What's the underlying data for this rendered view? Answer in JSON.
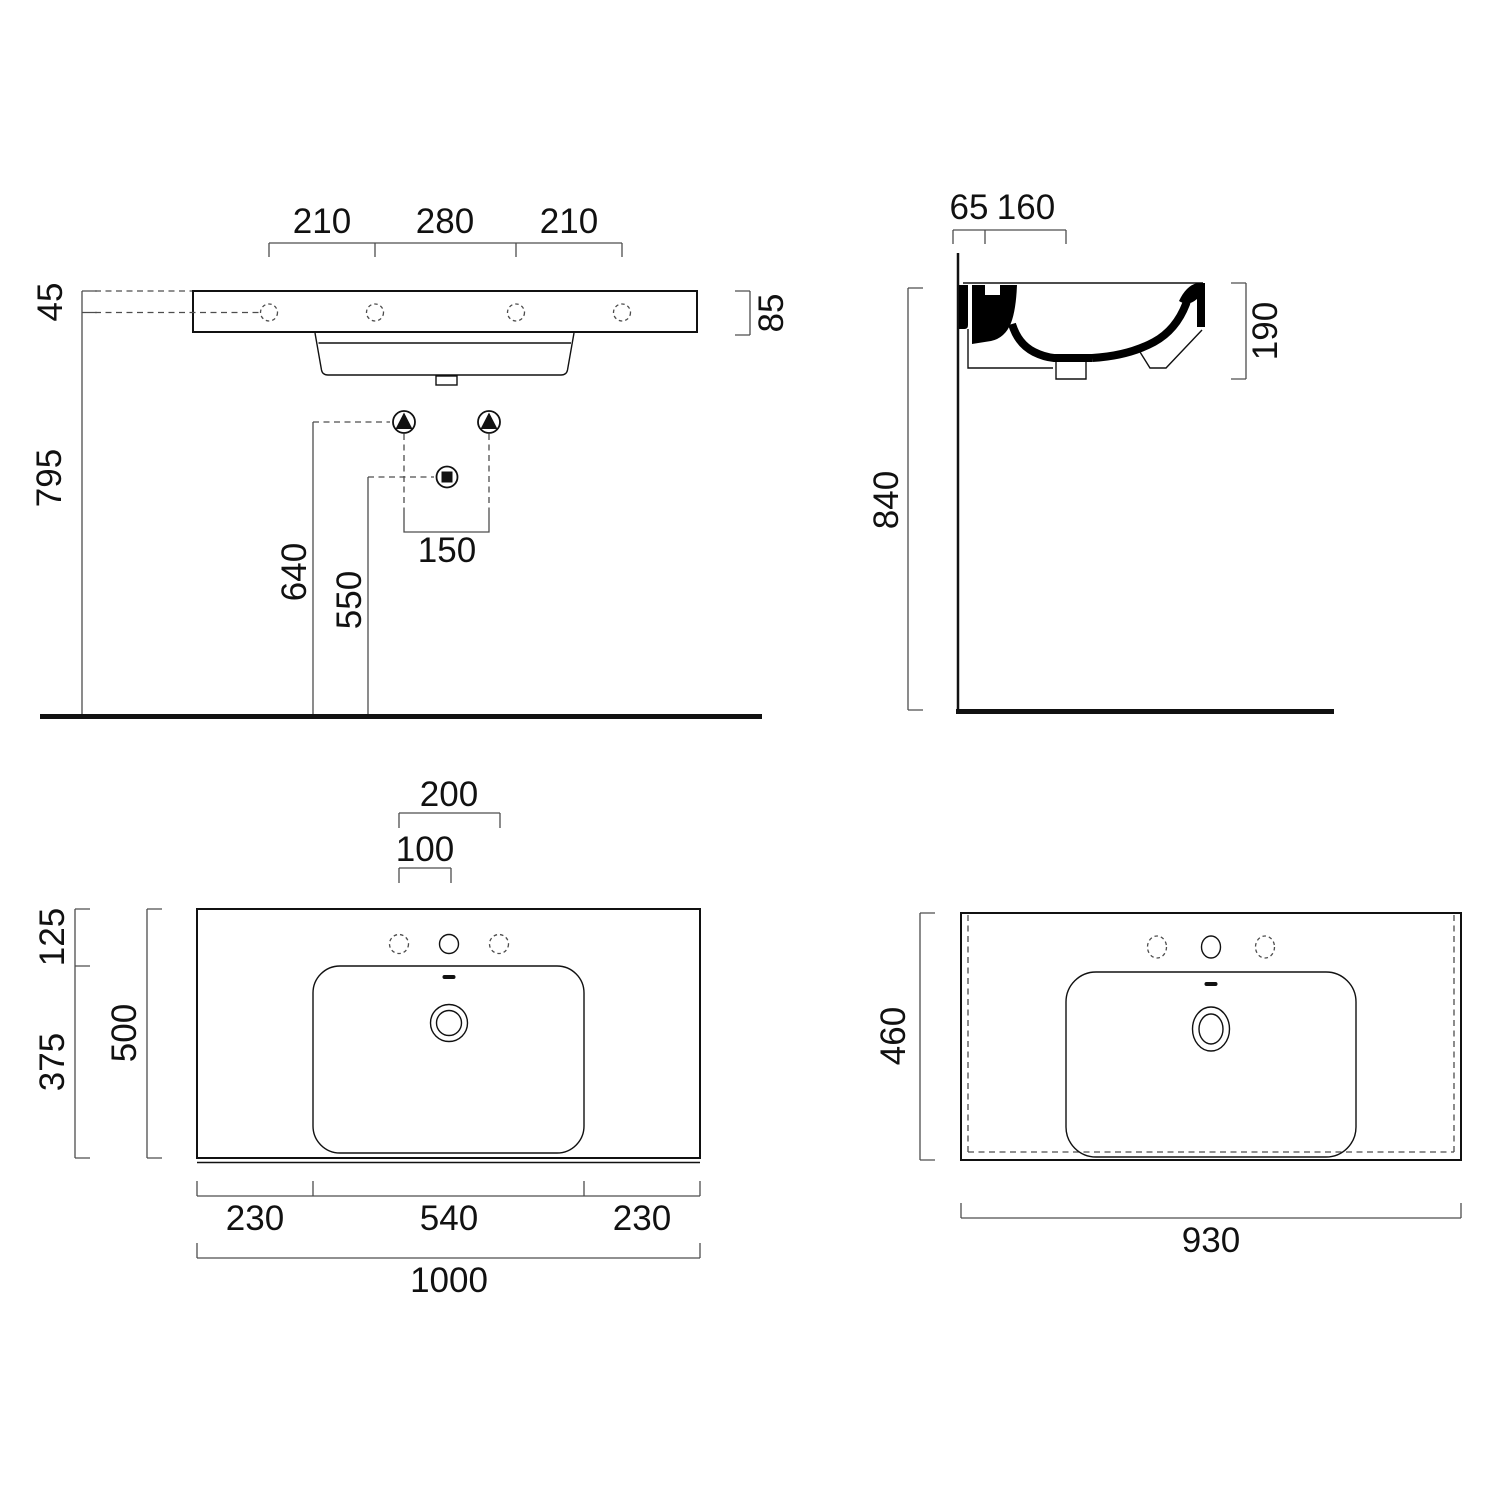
{
  "page": {
    "title": "Wall-hung washbasin technical drawing"
  },
  "colors": {
    "outline": "#111111",
    "dimension": "#4d4d4d",
    "text": "#111111",
    "thick_profile": "#000000",
    "background": "#ffffff"
  },
  "views": {
    "front_elevation": {
      "name": "Front elevation",
      "dims": {
        "hole_spacing_left": "210",
        "hole_spacing_center": "280",
        "hole_spacing_right": "210",
        "rim_to_hole": "45",
        "floor_to_hole": "795",
        "slab_height": "85",
        "supply_height": "640",
        "waste_height": "550",
        "supply_spacing": "150"
      }
    },
    "side_section": {
      "name": "Side section",
      "dims": {
        "wall_offset": "65",
        "deck_depth": "160",
        "basin_depth": "190",
        "floor_to_rim": "840"
      }
    },
    "top_plan": {
      "name": "Top plan",
      "dims": {
        "side_hole_spacing": "200",
        "hole_offset": "100",
        "rear_edge_to_bowl": "125",
        "bowl_depth": "375",
        "overall_depth": "500",
        "bowl_offset_left": "230",
        "bowl_width": "540",
        "bowl_offset_right": "230",
        "overall_width": "1000"
      }
    },
    "bottom_plan": {
      "name": "Bottom view",
      "dims": {
        "overall_depth": "460",
        "overall_width": "930"
      }
    }
  }
}
